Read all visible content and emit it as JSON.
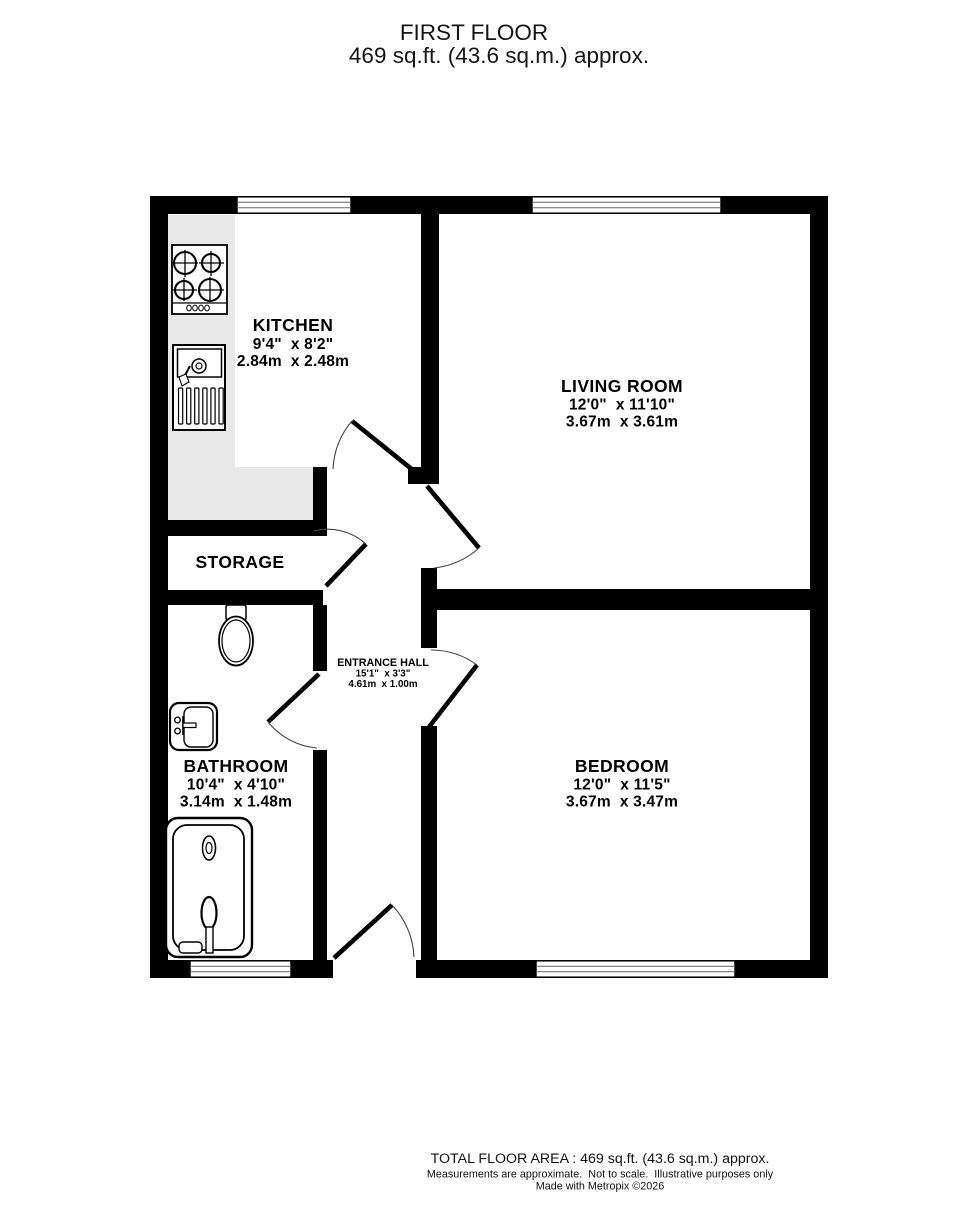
{
  "title": {
    "line1": "FIRST FLOOR",
    "line2": "469 sq.ft. (43.6 sq.m.) approx."
  },
  "rooms": {
    "kitchen": {
      "name": "KITCHEN",
      "imperial": "9'4\"  x 8'2\"",
      "metric": "2.84m  x 2.48m"
    },
    "living_room": {
      "name": "LIVING ROOM",
      "imperial": "12'0\"  x 11'10\"",
      "metric": "3.67m  x 3.61m"
    },
    "storage": {
      "name": "STORAGE"
    },
    "entrance_hall": {
      "name": "ENTRANCE HALL",
      "imperial": "15'1\"  x 3'3\"",
      "metric": "4.61m  x 1.00m"
    },
    "bathroom": {
      "name": "BATHROOM",
      "imperial": "10'4\"  x 4'10\"",
      "metric": "3.14m  x 1.48m"
    },
    "bedroom": {
      "name": "BEDROOM",
      "imperial": "12'0\"  x 11'5\"",
      "metric": "3.67m  x 3.47m"
    }
  },
  "footer": {
    "line1": "TOTAL FLOOR AREA : 469 sq.ft. (43.6 sq.m.) approx.",
    "line2": "Measurements are approximate.  Not to scale.  Illustrative purposes only",
    "line3": "Made with Metropix ©2026"
  },
  "colors": {
    "wall": "#000000",
    "counter": "#e8e8e8",
    "background": "#ffffff"
  }
}
